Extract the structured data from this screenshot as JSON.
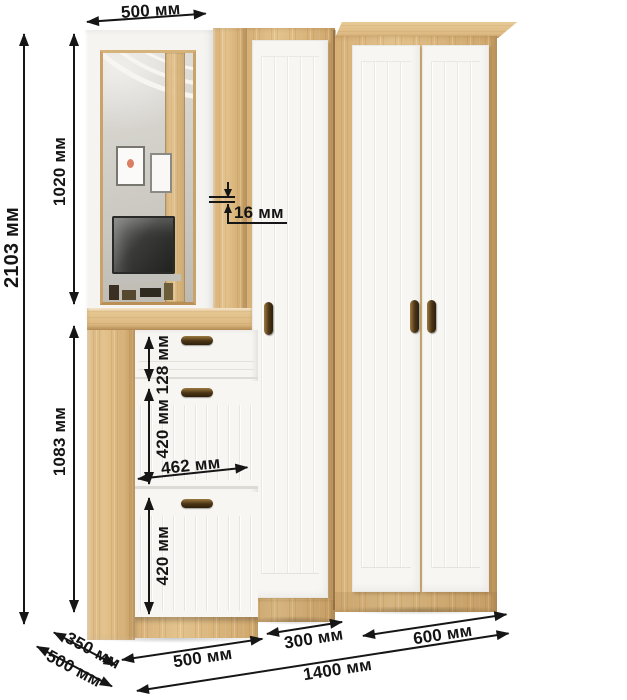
{
  "diagram": {
    "kind": "furniture dimension drawing",
    "subject": "hallway set: mirror panel with shoe cabinet, single-door wardrobe, double-door wardrobe",
    "units": "мм",
    "colors": {
      "wood": "#d9b67c",
      "front_white": "#f7f6f3",
      "annotation": "#161616"
    }
  },
  "dims": {
    "total_height": "2103 мм",
    "mirror_section_width": "500 мм",
    "mirror_height": "1020 мм",
    "panel_thickness": "16 мм",
    "shoe_cabinet_height": "1083 мм",
    "drawer_height": "128 мм",
    "upper_flap_height": "420 мм",
    "front_width": "462 мм",
    "lower_flap_height": "420 мм",
    "shoe_cabinet_width": "500 мм",
    "single_wardrobe_width": "300 мм",
    "double_wardrobe_width": "600 мм",
    "total_width": "1400 мм",
    "mirror_section_depth": "350 мм",
    "wardrobe_depth": "500 мм"
  }
}
